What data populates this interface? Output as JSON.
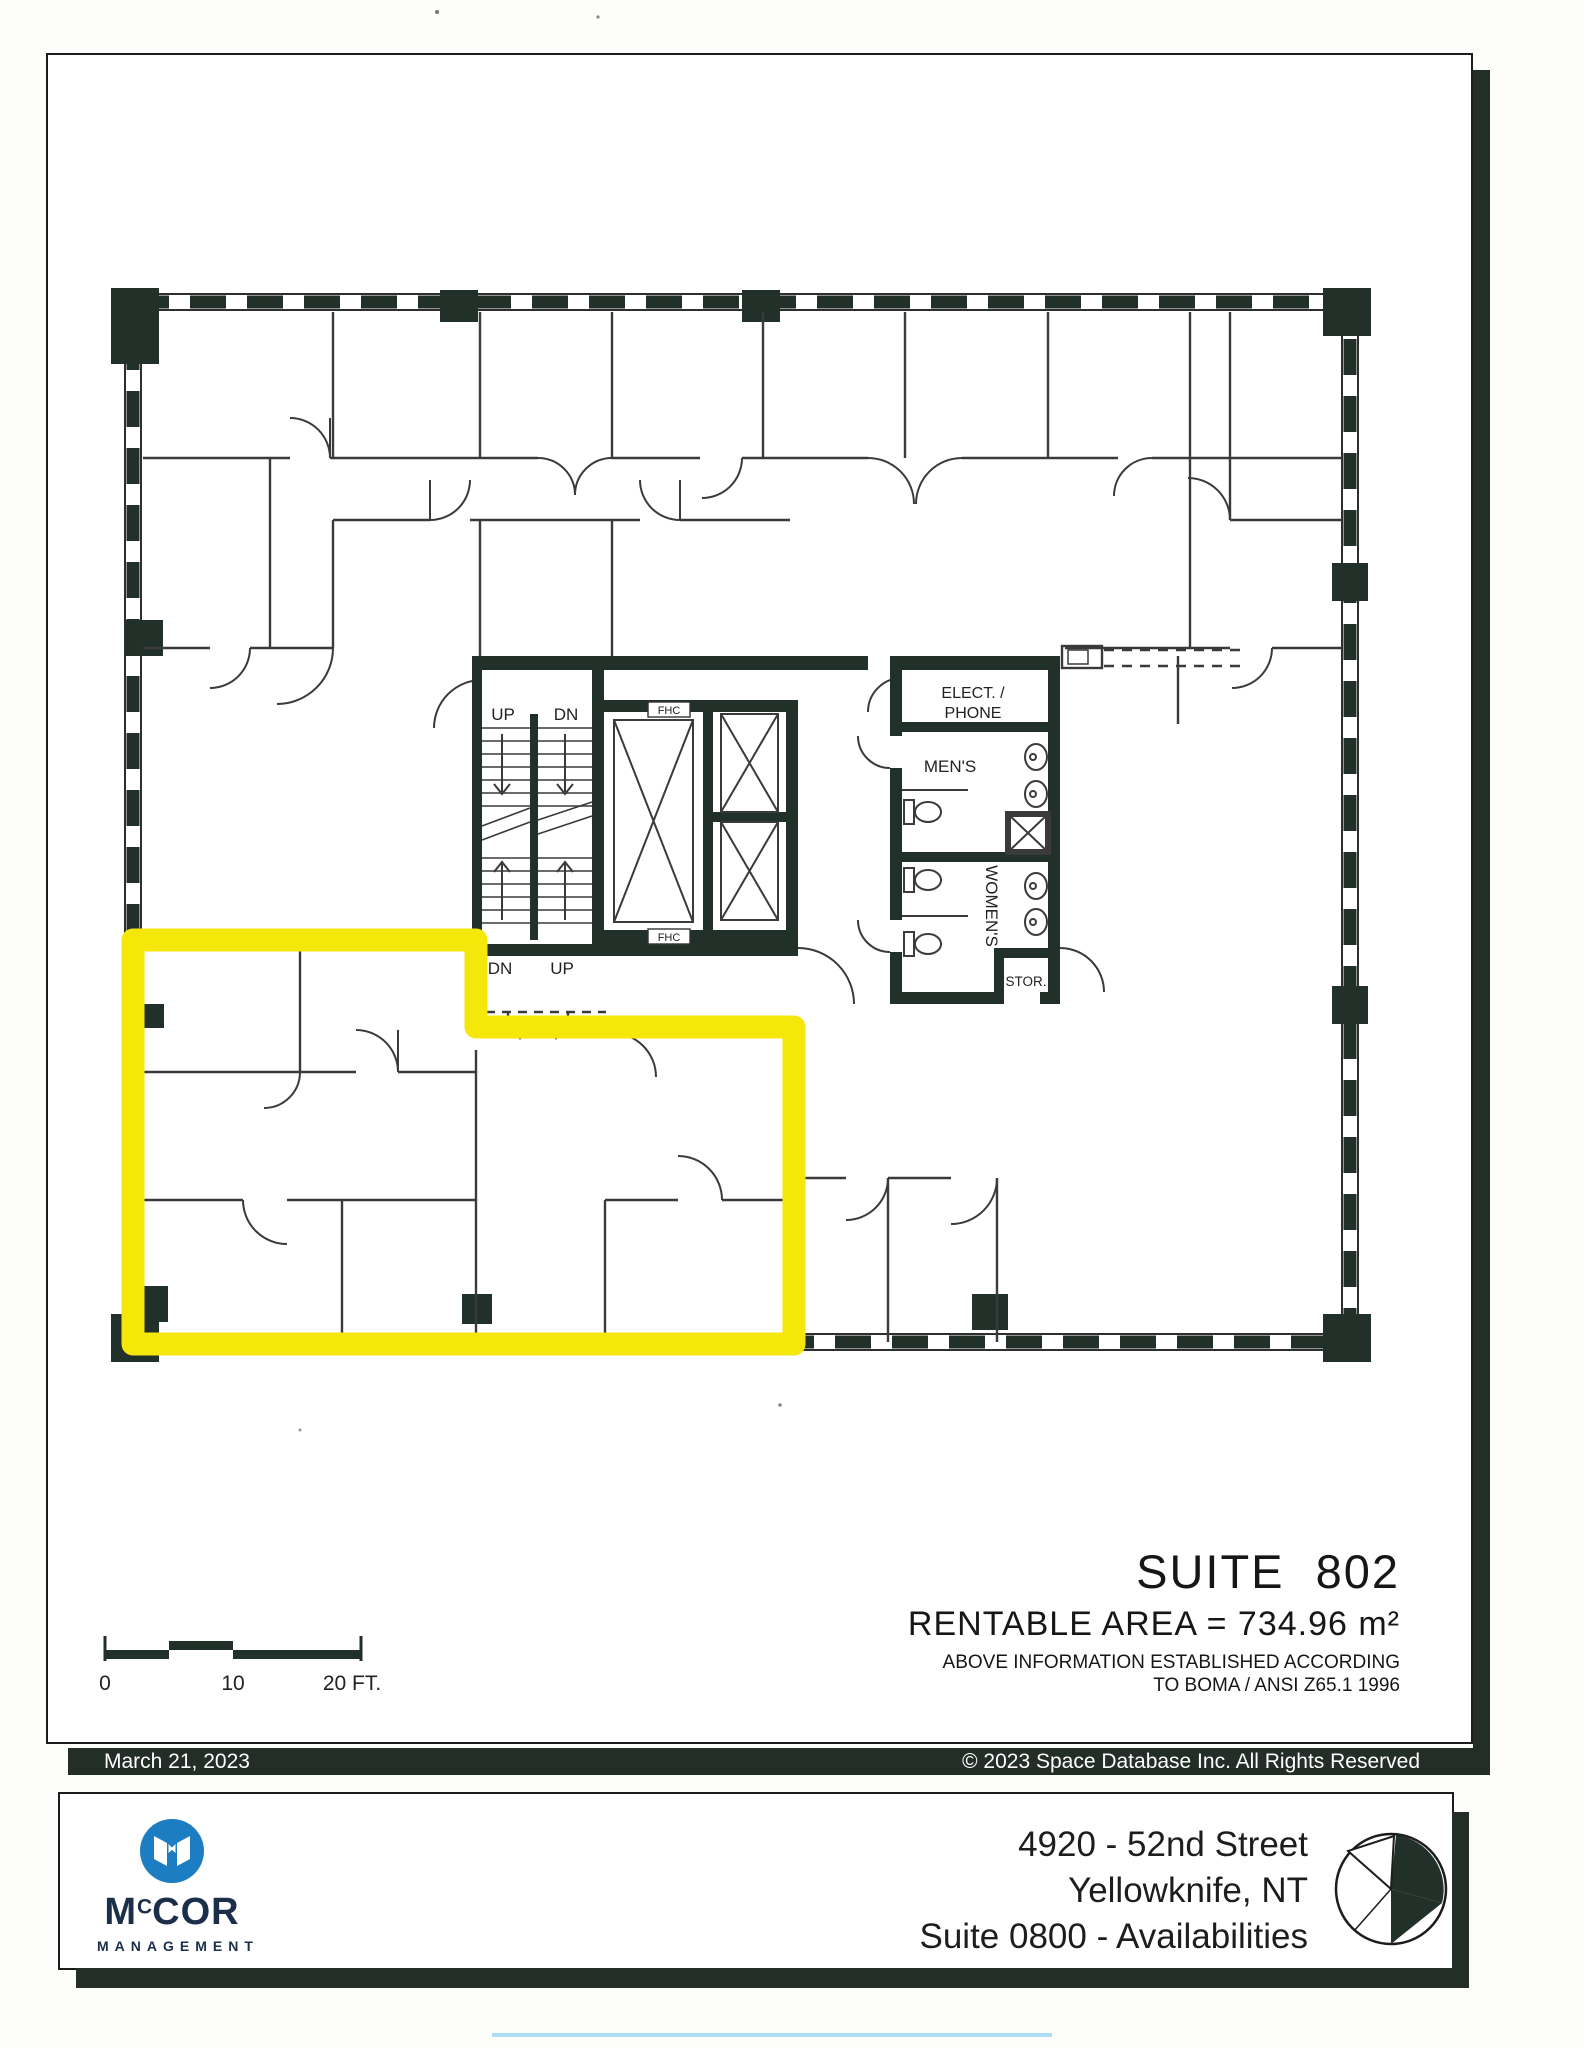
{
  "sheet": {
    "date": "March 21, 2023",
    "copyright": "© 2023 Space Database Inc. All Rights Reserved"
  },
  "title_block": {
    "suite": "SUITE 802",
    "rentable_area": "RENTABLE AREA = 734.96 m²",
    "boma_line1": "ABOVE INFORMATION ESTABLISHED ACCORDING",
    "boma_line2": "TO BOMA / ANSI Z65.1 1996"
  },
  "scale_bar": {
    "zero": "0",
    "ten": "10",
    "twenty": "20 FT."
  },
  "plan": {
    "highlight_color": "#F6E70A",
    "labels": {
      "up": "UP",
      "dn": "DN",
      "fhc": "FHC",
      "elect_phone_line1": "ELECT. /",
      "elect_phone_line2": "PHONE",
      "mens": "MEN'S",
      "womens": "WOMEN'S",
      "stor": "STOR."
    }
  },
  "footer": {
    "logo": {
      "brand_m": "M",
      "brand_c": "C",
      "brand_cor": "COR",
      "subtitle": "MANAGEMENT",
      "circle_color": "#1D7DC2"
    },
    "address_line1": "4920 - 52nd Street",
    "address_line2": "Yellowknife, NT",
    "address_line3": "Suite 0800 - Availabilities"
  }
}
